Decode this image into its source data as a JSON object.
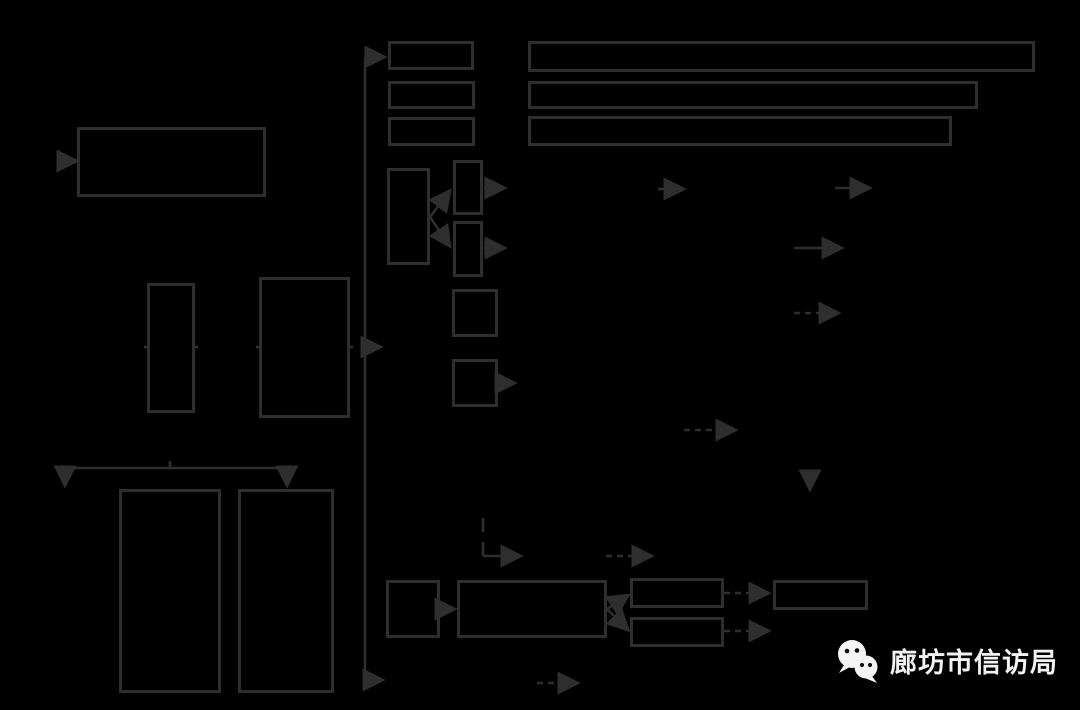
{
  "page": {
    "width": 1080,
    "height": 710,
    "background_color": "#000000",
    "line_color": "#2e2e2e"
  },
  "footer": {
    "brand_text": "廊坊市信访局",
    "text_color": "#f2f2f2",
    "logo": "wechat-logo",
    "logo_fill": "#f5f5f5",
    "logo_eye_color": "#0a0a0a"
  },
  "boxes": [
    {
      "name": "box-top-left-large",
      "x": 77,
      "y": 127,
      "w": 189,
      "h": 70
    },
    {
      "name": "box-left-narrow-tall",
      "x": 147,
      "y": 283,
      "w": 48,
      "h": 130
    },
    {
      "name": "box-left-mid-tall",
      "x": 259,
      "y": 277,
      "w": 91,
      "h": 141
    },
    {
      "name": "box-column-row-1",
      "x": 388,
      "y": 41,
      "w": 86,
      "h": 29
    },
    {
      "name": "box-column-row-2",
      "x": 388,
      "y": 81,
      "w": 87,
      "h": 28
    },
    {
      "name": "box-column-row-3",
      "x": 388,
      "y": 117,
      "w": 87,
      "h": 29
    },
    {
      "name": "box-long-row-1",
      "x": 528,
      "y": 41,
      "w": 507,
      "h": 31
    },
    {
      "name": "box-long-row-2",
      "x": 528,
      "y": 81,
      "w": 450,
      "h": 28
    },
    {
      "name": "box-long-row-3",
      "x": 528,
      "y": 116,
      "w": 424,
      "h": 30
    },
    {
      "name": "box-mid-tall",
      "x": 387,
      "y": 168,
      "w": 43,
      "h": 97
    },
    {
      "name": "box-pair-upper",
      "x": 453,
      "y": 160,
      "w": 30,
      "h": 55
    },
    {
      "name": "box-pair-lower",
      "x": 453,
      "y": 221,
      "w": 30,
      "h": 56
    },
    {
      "name": "box-square-1",
      "x": 452,
      "y": 289,
      "w": 46,
      "h": 48
    },
    {
      "name": "box-square-2",
      "x": 452,
      "y": 359,
      "w": 46,
      "h": 48
    },
    {
      "name": "box-bottom-left-1",
      "x": 119,
      "y": 489,
      "w": 102,
      "h": 204
    },
    {
      "name": "box-bottom-left-2",
      "x": 238,
      "y": 489,
      "w": 96,
      "h": 204
    },
    {
      "name": "box-bottom-small",
      "x": 386,
      "y": 580,
      "w": 54,
      "h": 58
    },
    {
      "name": "box-bottom-wide",
      "x": 457,
      "y": 580,
      "w": 150,
      "h": 58
    },
    {
      "name": "box-stack-upper",
      "x": 630,
      "y": 578,
      "w": 94,
      "h": 30
    },
    {
      "name": "box-stack-lower",
      "x": 630,
      "y": 617,
      "w": 94,
      "h": 30
    },
    {
      "name": "box-bottom-right",
      "x": 773,
      "y": 580,
      "w": 95,
      "h": 30
    }
  ],
  "connectors": [
    {
      "name": "spine-line",
      "points": [
        [
          365,
          57
        ],
        [
          365,
          680
        ]
      ]
    },
    {
      "name": "spine-top-arrow",
      "points": [
        [
          365,
          57
        ],
        [
          383,
          57
        ]
      ],
      "arrow": true
    },
    {
      "name": "spine-mid-arrow",
      "points": [
        [
          365,
          347
        ],
        [
          379,
          347
        ]
      ],
      "arrow": true
    },
    {
      "name": "spine-bottom-arrow",
      "points": [
        [
          365,
          680
        ],
        [
          381,
          680
        ]
      ],
      "arrow": true
    },
    {
      "name": "bigbox-in-arrowhead",
      "points": [
        [
          68,
          161
        ],
        [
          75,
          161
        ]
      ],
      "arrow": true
    },
    {
      "name": "row-stub-1",
      "points": [
        [
          144,
          347
        ],
        [
          150,
          347
        ]
      ]
    },
    {
      "name": "row-stub-2",
      "points": [
        [
          192,
          347
        ],
        [
          198,
          347
        ]
      ]
    },
    {
      "name": "row-stub-3",
      "points": [
        [
          256,
          347
        ],
        [
          262,
          347
        ]
      ]
    },
    {
      "name": "row-stub-4",
      "points": [
        [
          347,
          347
        ],
        [
          353,
          347
        ]
      ]
    },
    {
      "name": "bottomleft-hline",
      "points": [
        [
          65,
          468
        ],
        [
          287,
          468
        ]
      ]
    },
    {
      "name": "bottomleft-stub",
      "points": [
        [
          170,
          461
        ],
        [
          170,
          468
        ]
      ]
    },
    {
      "name": "bottomleft-arrow-l",
      "points": [
        [
          65,
          468
        ],
        [
          65,
          484
        ]
      ],
      "arrow": true
    },
    {
      "name": "bottomleft-arrow-r",
      "points": [
        [
          287,
          468
        ],
        [
          287,
          484
        ]
      ],
      "arrow": true
    },
    {
      "name": "midtall-branch-up",
      "points": [
        [
          430,
          217
        ],
        [
          449,
          192
        ]
      ],
      "arrow": true
    },
    {
      "name": "midtall-branch-down",
      "points": [
        [
          430,
          217
        ],
        [
          449,
          245
        ]
      ],
      "arrow": true
    },
    {
      "name": "pair-upper-out",
      "points": [
        [
          484,
          188
        ],
        [
          503,
          188
        ]
      ],
      "arrow": true
    },
    {
      "name": "pair-lower-out",
      "points": [
        [
          484,
          248
        ],
        [
          503,
          248
        ]
      ],
      "arrow": true
    },
    {
      "name": "square2-out",
      "points": [
        [
          499,
          383
        ],
        [
          513,
          383
        ]
      ],
      "arrow": true
    },
    {
      "name": "mid-arrow-1",
      "points": [
        [
          658,
          189
        ],
        [
          682,
          189
        ]
      ],
      "arrow": true
    },
    {
      "name": "mid-arrow-2",
      "points": [
        [
          835,
          188
        ],
        [
          868,
          188
        ]
      ],
      "arrow": true
    },
    {
      "name": "mid-arrow-3",
      "points": [
        [
          794,
          248
        ],
        [
          840,
          248
        ]
      ],
      "arrow": true
    },
    {
      "name": "mid-dashed-1",
      "points": [
        [
          794,
          313
        ],
        [
          837,
          313
        ]
      ],
      "arrow": true,
      "dash": "6 5"
    },
    {
      "name": "mid-dashed-2",
      "points": [
        [
          684,
          430
        ],
        [
          734,
          430
        ]
      ],
      "arrow": true,
      "dash": "6 5"
    },
    {
      "name": "down-arrowhead",
      "points": [
        [
          810,
          477
        ],
        [
          810,
          488
        ]
      ],
      "arrow": true
    },
    {
      "name": "elbow-vertical",
      "points": [
        [
          483,
          518
        ],
        [
          483,
          556
        ]
      ],
      "dash": "14 10"
    },
    {
      "name": "elbow-horizontal",
      "points": [
        [
          483,
          556
        ],
        [
          519,
          556
        ]
      ],
      "arrow": true
    },
    {
      "name": "mid-dashed-3",
      "points": [
        [
          606,
          556
        ],
        [
          650,
          556
        ]
      ],
      "arrow": true,
      "dash": "6 5"
    },
    {
      "name": "bottom-small-out",
      "points": [
        [
          440,
          609
        ],
        [
          453,
          609
        ]
      ],
      "arrow": true
    },
    {
      "name": "wide-branch-up",
      "points": [
        [
          607,
          609
        ],
        [
          627,
          596
        ]
      ],
      "arrow": true
    },
    {
      "name": "wide-branch-down",
      "points": [
        [
          607,
          609
        ],
        [
          627,
          629
        ]
      ],
      "arrow": true
    },
    {
      "name": "stack-upper-dashed",
      "points": [
        [
          724,
          593
        ],
        [
          767,
          593
        ]
      ],
      "arrow": true,
      "dash": "6 5"
    },
    {
      "name": "stack-lower-dashed",
      "points": [
        [
          724,
          631
        ],
        [
          767,
          631
        ]
      ],
      "arrow": true,
      "dash": "6 5"
    },
    {
      "name": "bottom-dashed",
      "points": [
        [
          537,
          683
        ],
        [
          576,
          683
        ]
      ],
      "arrow": true,
      "dash": "6 5"
    }
  ]
}
